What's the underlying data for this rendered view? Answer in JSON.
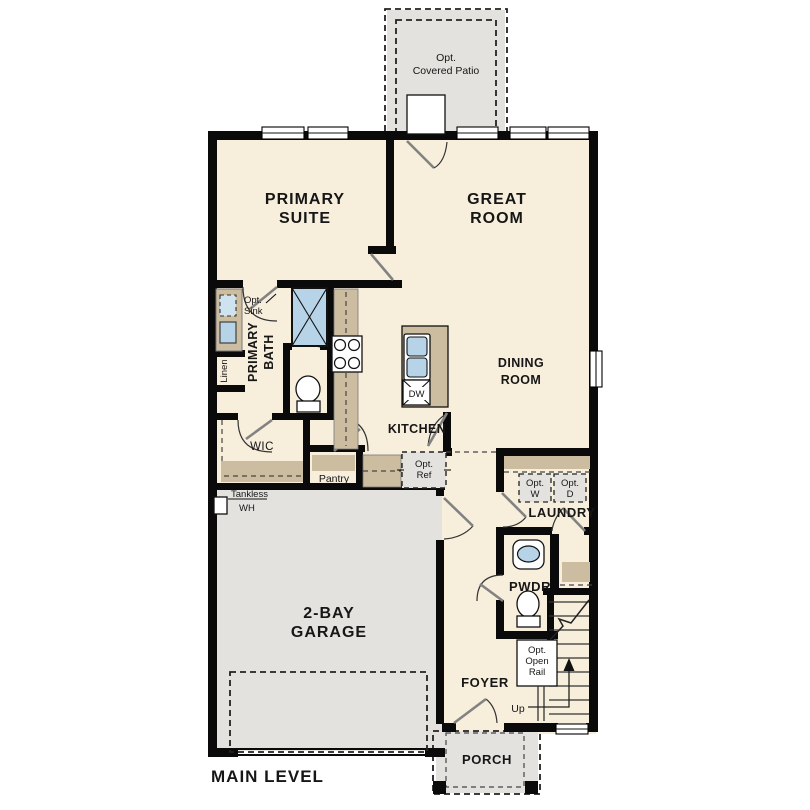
{
  "plan": {
    "level_label": "MAIN LEVEL",
    "colors": {
      "floor_cream": "#f7eedc",
      "exterior_gray": "#e3e2df",
      "counter_tan": "#ccbda0",
      "fixture_blue": "#b7d3e8",
      "wall_black": "#0a0a0a"
    },
    "rooms": {
      "patio": {
        "line1": "Opt.",
        "line2": "Covered Patio"
      },
      "primary_suite": {
        "line1": "PRIMARY",
        "line2": "SUITE"
      },
      "great_room": {
        "line1": "GREAT",
        "line2": "ROOM"
      },
      "dining_room": {
        "line1": "DINING",
        "line2": "ROOM"
      },
      "kitchen": {
        "label": "KITCHEN"
      },
      "primary_bath": {
        "line1": "PRIMARY",
        "line2": "BATH"
      },
      "wic": {
        "label": "WIC"
      },
      "pantry": {
        "label": "Pantry"
      },
      "garage": {
        "line1": "2-BAY",
        "line2": "GARAGE"
      },
      "laundry": {
        "label": "LAUNDRY"
      },
      "pwdr": {
        "label": "PWDR"
      },
      "foyer": {
        "label": "FOYER"
      },
      "porch": {
        "label": "PORCH"
      }
    },
    "features": {
      "opt_sink": {
        "line1": "Opt.",
        "line2": "Sink"
      },
      "linen": {
        "label": "Linen"
      },
      "dw": {
        "label": "DW"
      },
      "opt_ref": {
        "line1": "Opt.",
        "line2": "Ref"
      },
      "tankless_wh": {
        "line1": "Tankless",
        "line2": "WH"
      },
      "opt_washer": {
        "line1": "Opt.",
        "line2": "W"
      },
      "opt_dryer": {
        "line1": "Opt.",
        "line2": "D"
      },
      "opt_open_rail": {
        "line1": "Opt.",
        "line2": "Open",
        "line3": "Rail"
      },
      "up": {
        "label": "Up"
      }
    }
  }
}
